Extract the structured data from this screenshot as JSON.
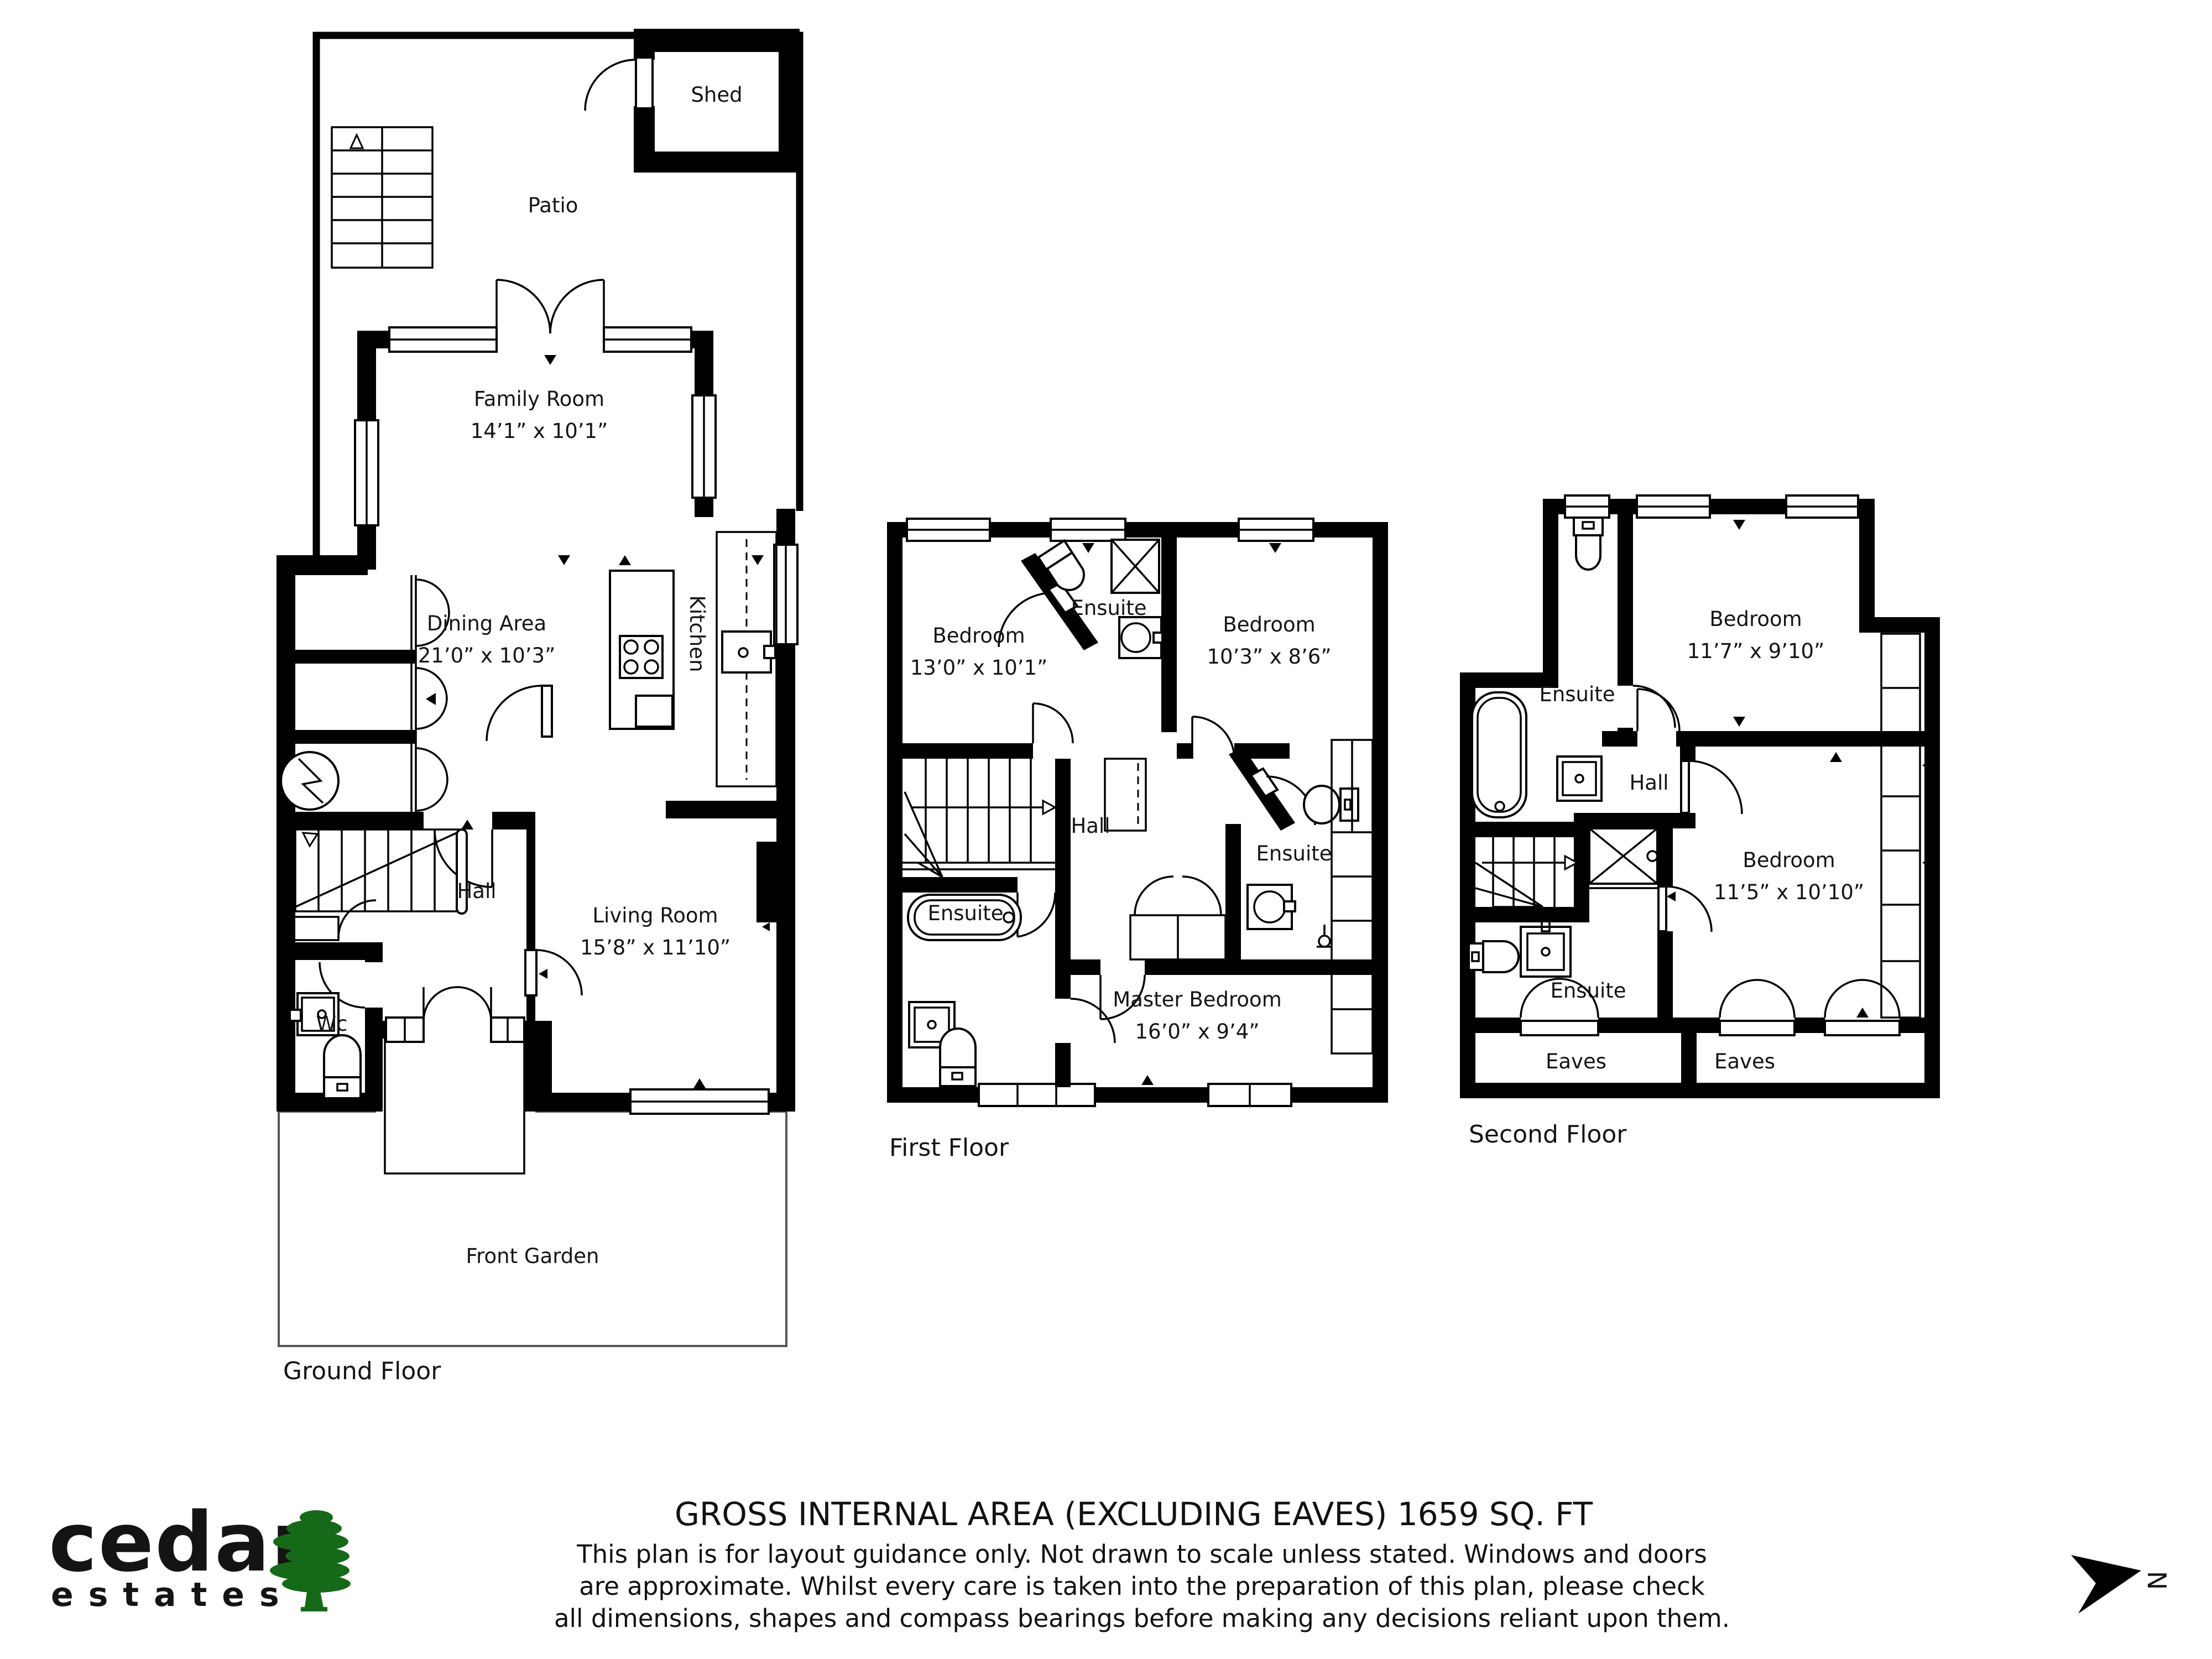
{
  "floors": {
    "ground": {
      "title": "Ground Floor",
      "rooms": {
        "shed": "Shed",
        "patio": "Patio",
        "family": {
          "name": "Family Room",
          "dims": "14’1” x 10’1”"
        },
        "dining": {
          "name": "Dining Area",
          "dims": "21’0” x 10’3”"
        },
        "kitchen": "Kitchen",
        "hall": "Hall",
        "living": {
          "name": "Living Room",
          "dims": "15’8” x 11’10”"
        },
        "wc": "Wc",
        "garden": "Front Garden"
      }
    },
    "first": {
      "title": "First Floor",
      "rooms": {
        "bedroom1": {
          "name": "Bedroom",
          "dims": "13’0” x 10’1”"
        },
        "ensuite_top": "Ensuite",
        "bedroom2": {
          "name": "Bedroom",
          "dims": "10’3” x 8’6”"
        },
        "hall": "Hall",
        "ensuite_right": "Ensuite",
        "ensuite_left": "Ensuite",
        "master": {
          "name": "Master Bedroom",
          "dims": "16’0” x 9’4”"
        }
      }
    },
    "second": {
      "title": "Second Floor",
      "rooms": {
        "ensuite_top": "Ensuite",
        "bedroom1": {
          "name": "Bedroom",
          "dims": "11’7” x 9’10”"
        },
        "hall": "Hall",
        "bedroom2": {
          "name": "Bedroom",
          "dims": "11’5” x 10’10”"
        },
        "ensuite_bottom": "Ensuite",
        "eaves1": "Eaves",
        "eaves2": "Eaves"
      }
    }
  },
  "footer": {
    "area_title": "GROSS INTERNAL AREA (EXCLUDING EAVES) 1659 SQ. FT",
    "disclaimer_line1": "This plan is for layout guidance only. Not drawn to scale unless stated. Windows and doors",
    "disclaimer_line2": "are approximate. Whilst every care is taken into the preparation of this plan, please check",
    "disclaimer_line3": "all dimensions, shapes and compass bearings before making any decisions reliant upon them."
  },
  "logo": {
    "brand": "cedar",
    "sub": "estates",
    "brand_color": "#44302b",
    "tree_color": "#166918"
  },
  "compass": {
    "label": "N"
  }
}
